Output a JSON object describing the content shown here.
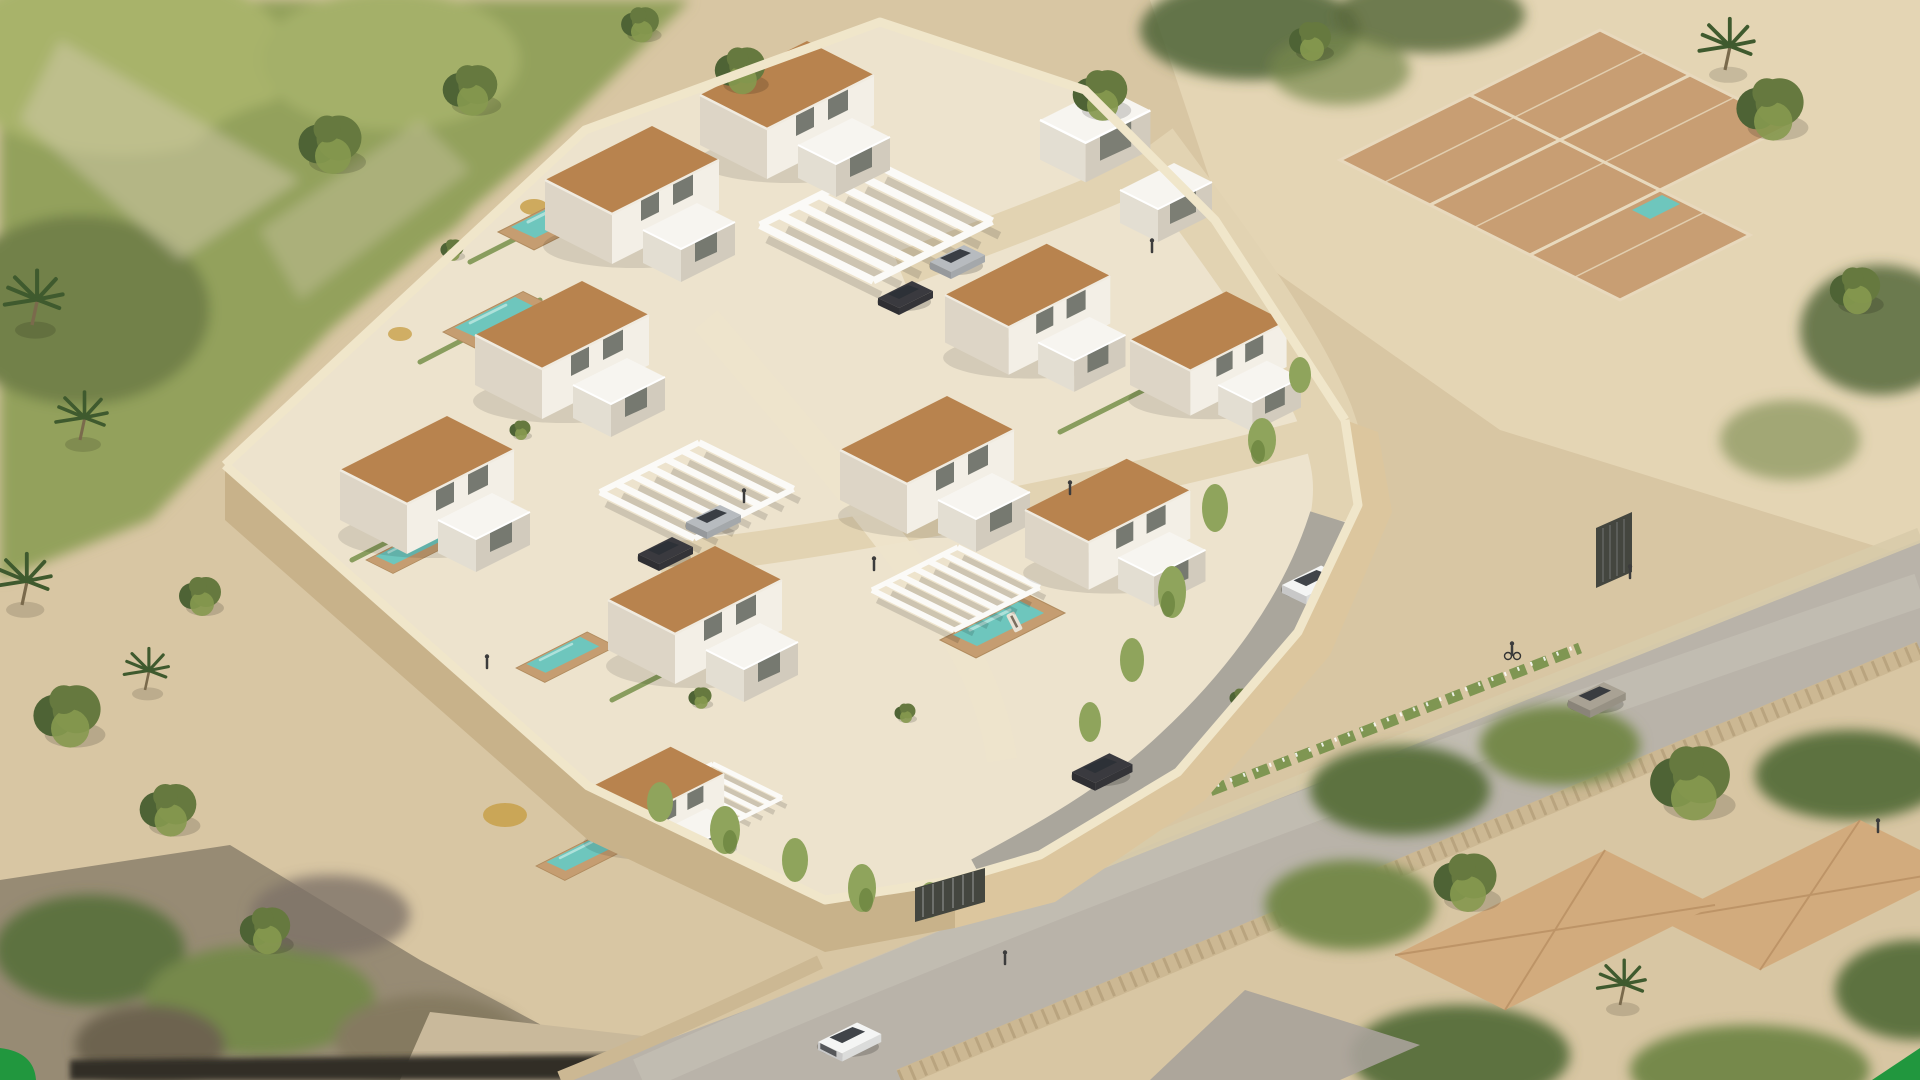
{
  "image": {
    "kind": "3D aerial architectural rendering",
    "alt": "Aerial isometric 3D render of a walled residential development: ten modern white villas with terracotta pitched roofs and white cube annexes, private turquoise pools with sun decks, white slatted pergola carports with parked cars, a cream internal road winding from a top entrance down to a street gate, tall cream perimeter walls draped with green vines, sandy surroundings with palm trees, a blurred green hillside at top left, neighbouring lots with terracotta paved terraces and large hipped-roof houses, and a grey street with a white SUV, dark sedan, pickup truck, cyclist and pedestrians. Small green decorative wedges mark the bottom corners.",
    "width_px": 1920,
    "height_px": 1080
  },
  "palette": {
    "sandBase": "#d8c6a3",
    "sandLight": "#e7d8b8",
    "compoundGround": "#ede3cd",
    "roadCream": "#e2d3b2",
    "pathCream": "#eee4cb",
    "rampGray": "#aaa69c",
    "wallTop": "#f0e6ca",
    "wallFace": "#dcc69e",
    "wallFaceDark": "#c8b28a",
    "villaWallLight": "#f3efe6",
    "villaWallShade": "#ddd5c6",
    "roofMain": "#b8834e",
    "roofEdge": "#f0ebe0",
    "flatRoof": "#f7f5f0",
    "flatRoofShade": "#e3ded2",
    "flatRoofSide": "#d2cbbd",
    "windowDark": "#5f645c",
    "poolWater": "#6ec6bd",
    "poolWaterLight": "#bfe8e2",
    "poolDeck": "#c59d71",
    "pergolaWhite": "#fbfaf7",
    "hedgeGreen": "#7f9652",
    "vineGreen": "#8fa45c",
    "treeDark": "#4e6335",
    "treeMid": "#66793f",
    "treeLight": "#86994f",
    "vegBase": "#93a15c",
    "vegLight": "#a8b36a",
    "vegPale": "#cfc9a8",
    "palmGreen": "#3f5a2e",
    "streetGray": "#b9b3a9",
    "streetLight": "#c9c3b8",
    "sidewalk": "#d8cbaa",
    "stoneWall": "#ccb893",
    "stoneDot": "#ab9671",
    "gateDark": "#44463f",
    "pavingTile": "#c89e73",
    "pavingLine": "#e8d9bd",
    "nRoof": "#d2ab7d",
    "nRoofLine": "#b98f62",
    "nVegDark": "#5d7240",
    "nVegMid": "#76894c",
    "nGroundMuted": "#978b74",
    "nGroundPale": "#c9b99b",
    "shadowDark": "#332e26",
    "accentGreen": "#21973e",
    "carWhite": "#f4f5f4",
    "carDark": "#3a3a3f",
    "carSilver": "#b7bbbf",
    "carTan": "#a9a294",
    "personDark": "#3c3c3c"
  },
  "scene_inventory": {
    "villas_with_terracotta_roofs": 10,
    "white_flat_roof_cubes": 2,
    "private_pools": 6,
    "neighbor_pools": 2,
    "pergola_carports": 4,
    "vehicles": [
      "white SUV",
      "dark sedan (top carport)",
      "silver sedan (top carport)",
      "dark sedan (central carport)",
      "silver sedan (central carport)",
      "dark sedan (ramp)",
      "tan car (street)",
      "white pickup truck (street)"
    ],
    "people_visible": 11,
    "cyclists": 1,
    "gates": 2,
    "corner_accents": [
      "green quarter-round bottom-left",
      "green wedge bottom-right"
    ]
  }
}
